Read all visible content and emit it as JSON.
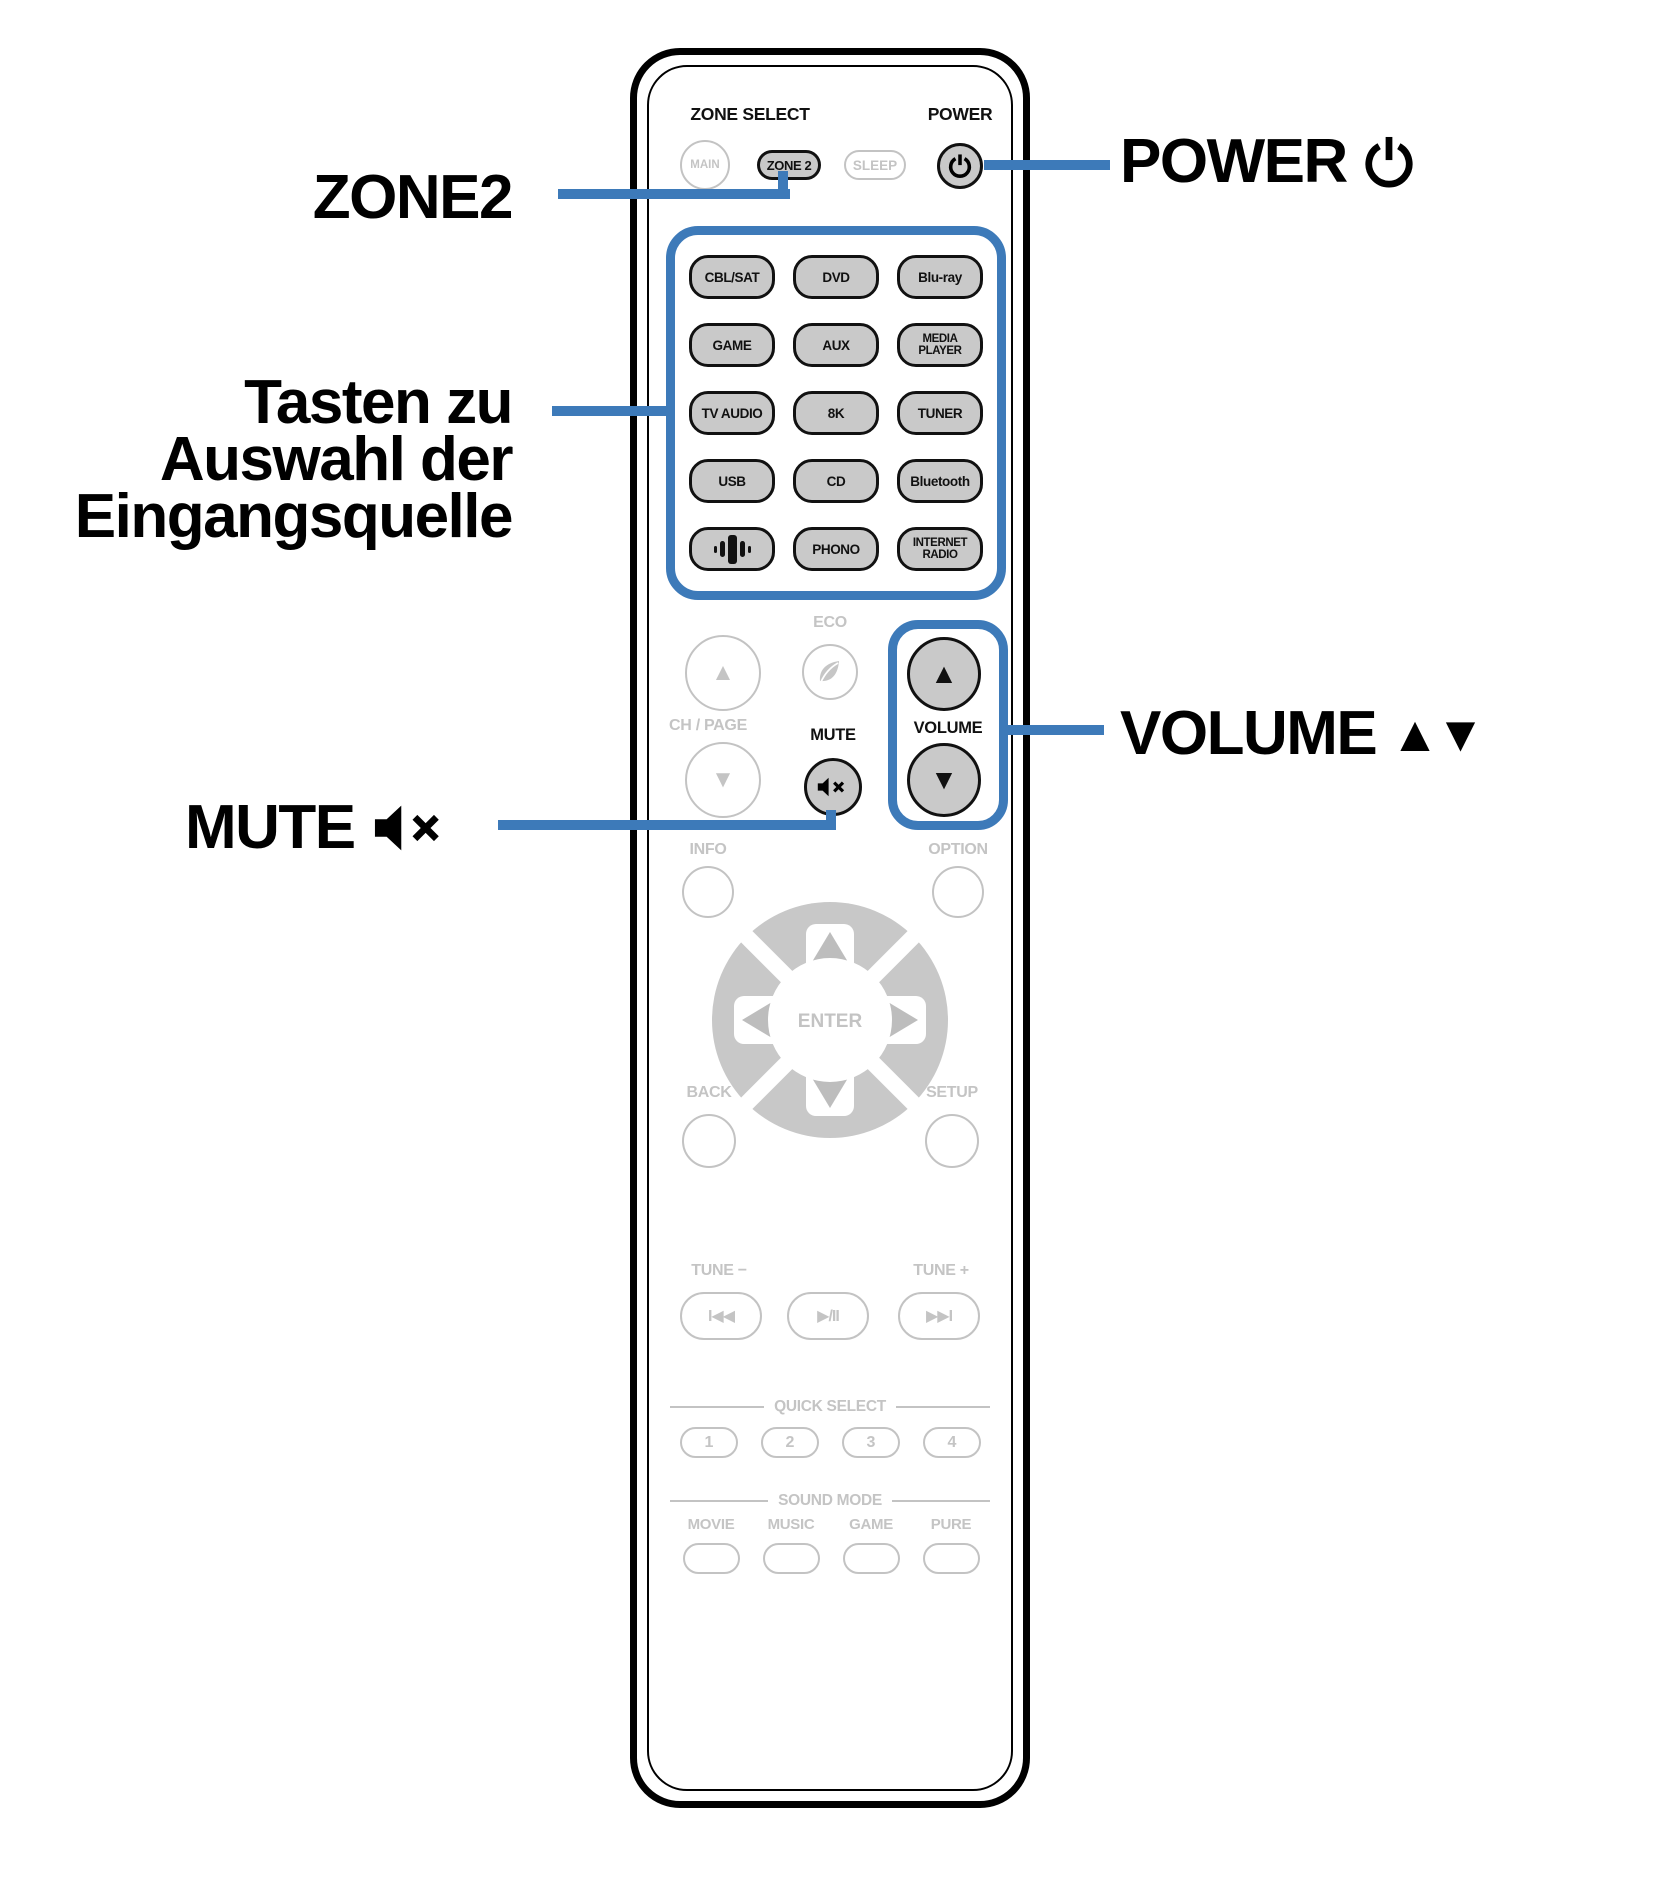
{
  "colors": {
    "accent_blue": "#3d7ab9",
    "active_button_fill": "#c9c9c9",
    "inactive_gray": "#c4c4c4"
  },
  "callouts": {
    "zone2": "ZONE2",
    "power": "POWER",
    "power_icon": "power-icon",
    "input_source": "Tasten zu\nAuswahl der\nEingangsquelle",
    "volume": "VOLUME",
    "volume_arrows": "▲▼",
    "mute": "MUTE",
    "mute_icon": "speaker-mute-icon"
  },
  "remote": {
    "zone_select_label": "ZONE SELECT",
    "power_label": "POWER",
    "zone_buttons": [
      "MAIN",
      "ZONE 2",
      "SLEEP"
    ],
    "input_buttons": [
      "CBL/SAT",
      "DVD",
      "Blu-ray",
      "GAME",
      "AUX",
      "MEDIA\nPLAYER",
      "TV AUDIO",
      "8K",
      "TUNER",
      "USB",
      "CD",
      "Bluetooth",
      "",
      "PHONO",
      "INTERNET\nRADIO"
    ],
    "heos_button_icon": "heos-bars-icon",
    "eco_label": "ECO",
    "eco_icon": "leaf-icon",
    "ch_page_label": "CH / PAGE",
    "arrow_up": "▲",
    "arrow_down": "▼",
    "mute_label": "MUTE",
    "volume_label": "VOLUME",
    "info_label": "INFO",
    "option_label": "OPTION",
    "enter_label": "ENTER",
    "back_label": "BACK",
    "setup_label": "SETUP",
    "tune_minus_label": "TUNE −",
    "tune_plus_label": "TUNE +",
    "transport_buttons": [
      "I◀◀",
      "▶/II",
      "▶▶I"
    ],
    "quick_select_label": "QUICK SELECT",
    "quick_select_buttons": [
      "1",
      "2",
      "3",
      "4"
    ],
    "sound_mode_label": "SOUND MODE",
    "sound_mode_labels": [
      "MOVIE",
      "MUSIC",
      "GAME",
      "PURE"
    ]
  }
}
